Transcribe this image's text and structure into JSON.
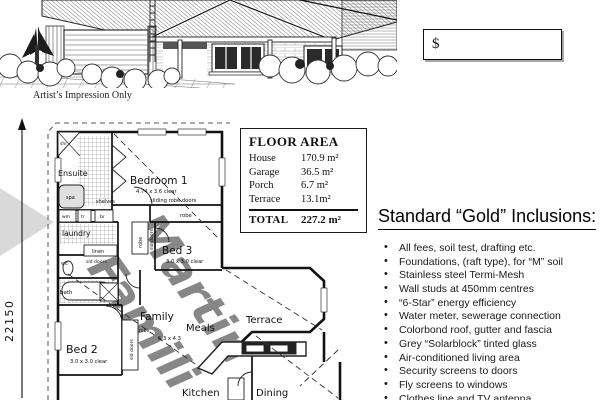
{
  "header": {
    "price_prefix": "$",
    "caption": "Artist’s Impression Only"
  },
  "floor_area": {
    "title": "FLOOR AREA",
    "rows": [
      {
        "label": "House",
        "value": "170.9 m²"
      },
      {
        "label": "Garage",
        "value": "36.5 m²"
      },
      {
        "label": "Porch",
        "value": "6.7 m²"
      },
      {
        "label": "Terrace",
        "value": "13.1m²"
      }
    ],
    "total": {
      "label": "TOTAL",
      "value": "227.2 m²"
    }
  },
  "inclusions": {
    "heading": "Standard “Gold” Inclusions:",
    "items": [
      "All fees, soil test, drafting etc.",
      "Foundations, (raft type), for “M” soil",
      "Stainless steel Termi-Mesh",
      "Wall studs at 450mm centres",
      "“6-Star” energy efficiency",
      "Water meter, sewerage connection",
      "Colorbond roof, gutter and fascia",
      "Grey “Solarblock” tinted glass",
      "Air-conditioned living area",
      "Security screens to doors",
      "Fly screens to windows",
      "Clothes line and TV antenna"
    ]
  },
  "plan": {
    "dimension_label": "22150",
    "labels": {
      "ensuite": "Ensuite",
      "shr": "shr",
      "spa": "spa",
      "wm": "wm",
      "tr": "tr",
      "br": "br",
      "shelves": "shelves",
      "sliding_robe_doors": "sliding  robe  doors",
      "robe": "robe",
      "bedroom1": "Bedroom 1",
      "bedroom1_size": "4.74 x 3.6 clear",
      "bed3": "Bed 3",
      "bed3_size": "3.0 x 3.0 clear",
      "bed3_robe": "robe",
      "bed3_sld": "sld doors",
      "laundry": "laundry",
      "linen": "linen",
      "linen_sld": "sld doors",
      "wc": "wc",
      "bath": "bath",
      "bed2": "Bed 2",
      "bed2_size": "3.0 x 3.0 clear",
      "bed2_sld": "sld doors",
      "bed2_robe": "robe",
      "family": "Family",
      "family_size": "5.3 x 4.3",
      "meals": "Meals",
      "terrace": "Terrace",
      "kitchen": "Kitchen",
      "dining": "Dining"
    },
    "watermark": {
      "line1": "Martin",
      "line2": "Famili"
    }
  },
  "colors": {
    "ink": "#111111",
    "watermark_gray": "#9c9c9c",
    "hatch_gray": "#777777"
  }
}
